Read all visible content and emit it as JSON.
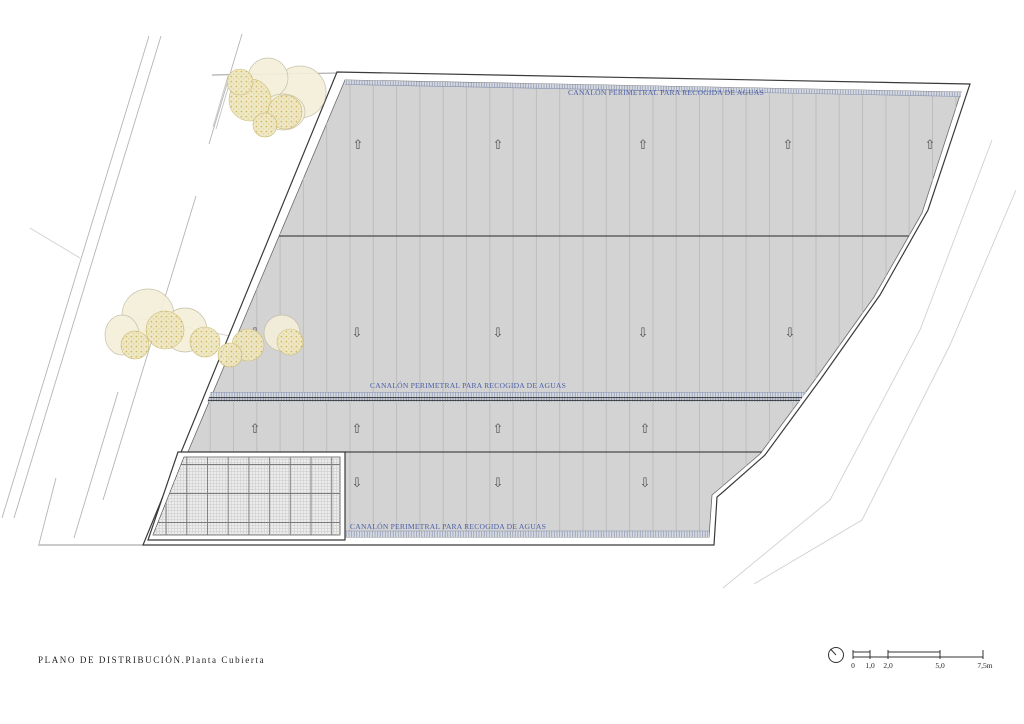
{
  "document": {
    "title": "PLANO DE DISTRIBUCIÓN.Planta Cubierta"
  },
  "plan": {
    "gutter_label": "CANALÓN PERIMETRAL PARA RECOGIDA DE AGUAS",
    "gutter_count": 3,
    "slope_arrow_rows": 4
  },
  "icons": {
    "slope_up_arrow": "⇧",
    "slope_down_arrow": "⇩",
    "orientation_dial": "clock-like dial with hand pointing upper-left"
  },
  "scale_bar": {
    "unit": "m",
    "tick_labels": [
      "0",
      "1,0",
      "2,0",
      "5,0",
      "7,5m"
    ]
  },
  "colors": {
    "roof_fill": "#d3d3d3",
    "roof_hatch": "#bdbdbd",
    "outline": "#3a3a3a",
    "gutter_label_blue": "#4a5fa8",
    "tree_fill": "#f4efda",
    "tree_speckle": "#cdb556"
  }
}
